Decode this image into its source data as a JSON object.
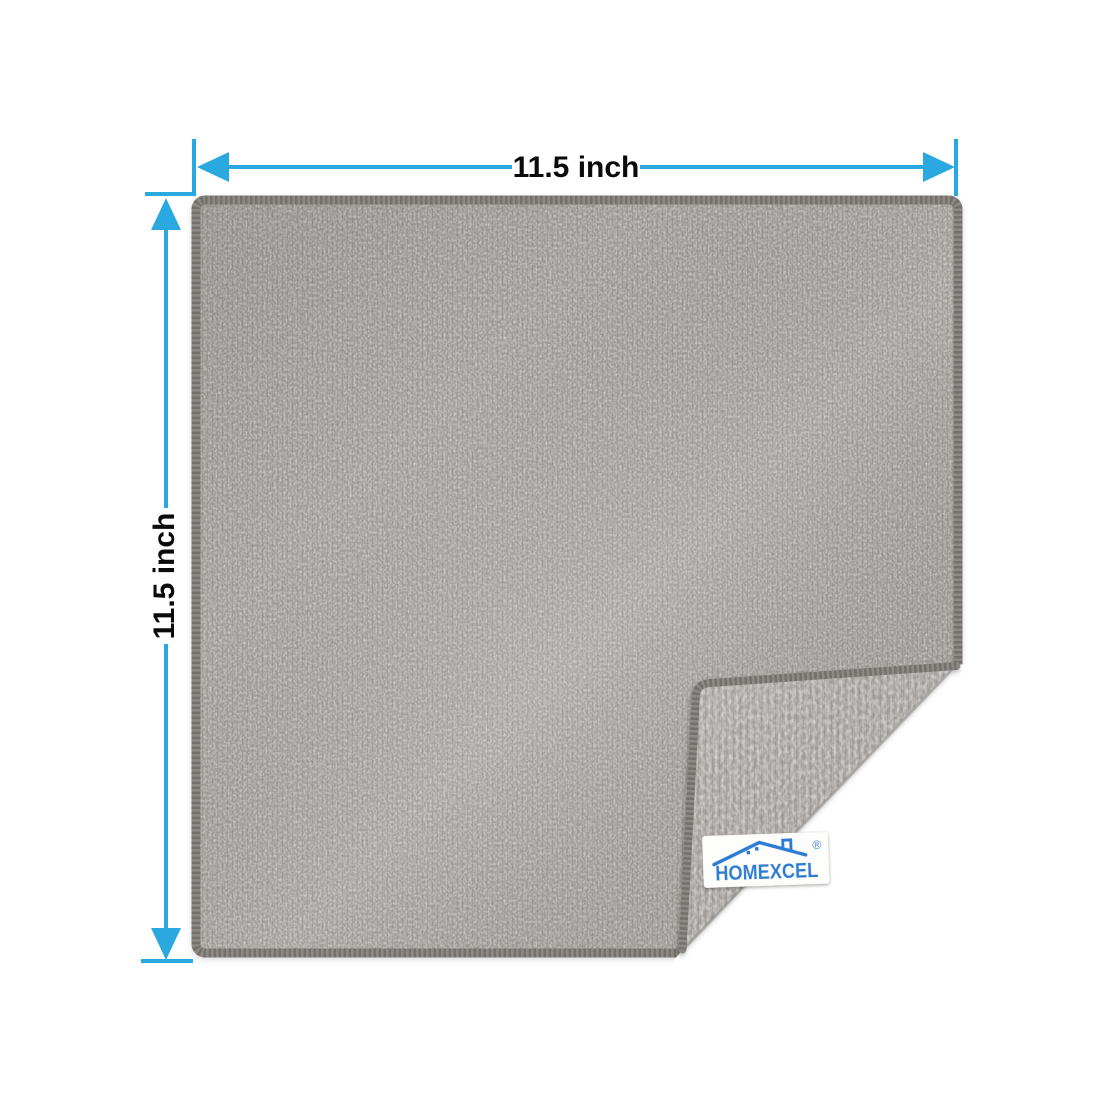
{
  "image_type": "product dimension photo",
  "subject": "Gray microfiber cleaning cloth with bottom-right corner folded over, showing reverse side and sewn-in brand tag",
  "dimensions": {
    "width_label": "11.5 inch",
    "height_label": "11.5 inch"
  },
  "brand_tag": {
    "name": "HOMEXCEL",
    "registered_mark": "®",
    "logo_icon": "house-roof-with-chimney"
  },
  "colors": {
    "background": "#ffffff",
    "dimension_accent": "#2aa9e0",
    "dimension_text": "#0a0a0a",
    "cloth_front": "#9b9793",
    "cloth_back": "#a7a39f",
    "cloth_edge_binding": "#8d8985",
    "tag_background": "#fdfdfc",
    "brand_blue": "#2b7dd2"
  }
}
